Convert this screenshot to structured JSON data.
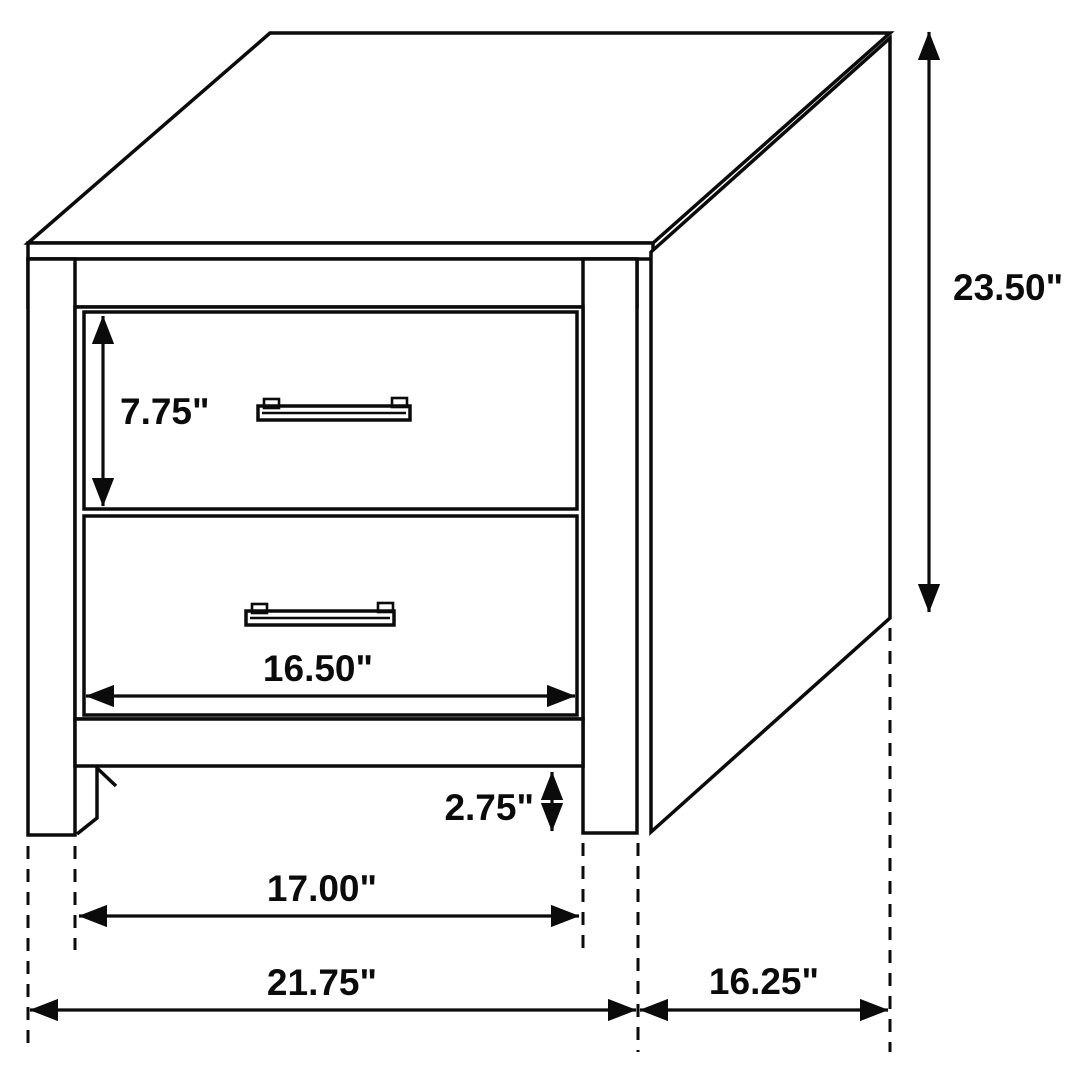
{
  "page": {
    "background": "#ffffff"
  },
  "diagram": {
    "subject": "two-drawer nightstand dimension drawing",
    "unit": "inches",
    "line_color": "#0b0b0b",
    "text_color": "#0b0b0b",
    "labels": {
      "overall_height": "23.50\"",
      "drawer_height": "7.75\"",
      "drawer_face_width": "16.50\"",
      "foot_clearance": "2.75\"",
      "inner_leg_span": "17.00\"",
      "overall_width": "21.75\"",
      "side_depth": "16.25\""
    }
  }
}
